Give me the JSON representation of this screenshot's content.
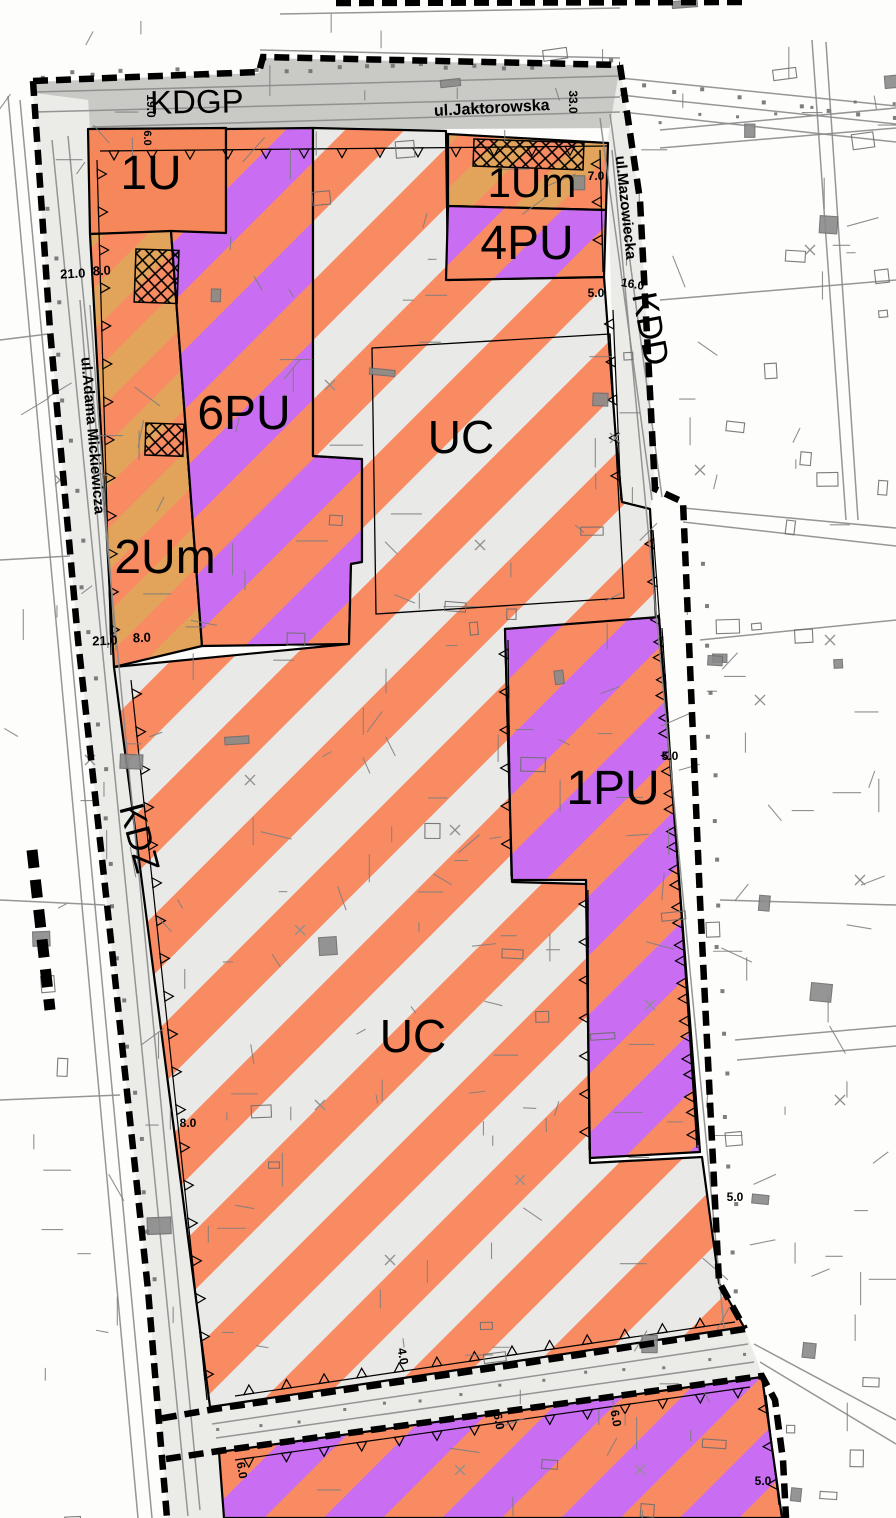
{
  "map_title": "zoning-plan-map",
  "roads": {
    "kdgp": "KDGP",
    "kdd": "KDD",
    "kdz": "KDZ"
  },
  "streets": {
    "jaktorowska": "ul.Jaktorowska",
    "mazowiecka": "ul.Mazowiecka",
    "mickiewicza": "ul.Adama Mickiewicza"
  },
  "zones": [
    {
      "id": "1U",
      "label": "1U"
    },
    {
      "id": "1Um",
      "label": "1Um"
    },
    {
      "id": "4PU",
      "label": "4PU"
    },
    {
      "id": "6PU",
      "label": "6PU"
    },
    {
      "id": "2Um",
      "label": "2Um"
    },
    {
      "id": "UC-north",
      "label": "UC"
    },
    {
      "id": "1PU",
      "label": "1PU"
    },
    {
      "id": "UC-south",
      "label": "UC"
    }
  ],
  "labels": [
    {
      "name": "road-label-kdgp",
      "text": "KDGP",
      "x": 197,
      "y": 113,
      "r": -1,
      "size": 33,
      "weight": 400
    },
    {
      "name": "street-label-jaktorowska",
      "text": "ul.Jaktorowska",
      "x": 492,
      "y": 113,
      "r": -3,
      "size": 16,
      "weight": 700
    },
    {
      "name": "dim-19-0",
      "text": "19.0",
      "x": 147,
      "y": 106,
      "r": 90,
      "size": 12,
      "weight": 700
    },
    {
      "name": "dim-6-0-a",
      "text": "6.0",
      "x": 144,
      "y": 138,
      "r": 90,
      "size": 11,
      "weight": 700
    },
    {
      "name": "dim-33-0",
      "text": "33.0",
      "x": 569,
      "y": 102,
      "r": 90,
      "size": 12,
      "weight": 700
    },
    {
      "name": "zone-label-1u",
      "text": "1U",
      "x": 151,
      "y": 189,
      "r": 0,
      "size": 48,
      "weight": 400
    },
    {
      "name": "zone-label-1um",
      "text": "1Um",
      "x": 532,
      "y": 197,
      "r": 0,
      "size": 42,
      "weight": 400
    },
    {
      "name": "dim-7-0",
      "text": "7.0",
      "x": 596,
      "y": 180,
      "r": 0,
      "size": 12,
      "weight": 700
    },
    {
      "name": "zone-label-4pu",
      "text": "4PU",
      "x": 527,
      "y": 259,
      "r": 0,
      "size": 48,
      "weight": 400
    },
    {
      "name": "street-label-mazowiecka",
      "text": "ul.Mazowiecka",
      "x": 621,
      "y": 208,
      "r": 84,
      "size": 15,
      "weight": 700
    },
    {
      "name": "dim-5-0-a",
      "text": "5.0",
      "x": 596,
      "y": 297,
      "r": 0,
      "size": 12,
      "weight": 700
    },
    {
      "name": "dim-16-0",
      "text": "16.0",
      "x": 632,
      "y": 288,
      "r": 10,
      "size": 12,
      "weight": 700
    },
    {
      "name": "road-label-kdd",
      "text": "KDD",
      "x": 639,
      "y": 331,
      "r": 79,
      "size": 35,
      "weight": 400
    },
    {
      "name": "dim-21-0-a",
      "text": "21.0",
      "x": 73,
      "y": 278,
      "r": -3,
      "size": 13,
      "weight": 700
    },
    {
      "name": "dim-8-0-a",
      "text": "8.0",
      "x": 102,
      "y": 275,
      "r": -3,
      "size": 13,
      "weight": 700
    },
    {
      "name": "zone-label-6pu",
      "text": "6PU",
      "x": 244,
      "y": 429,
      "r": 0,
      "size": 48,
      "weight": 400
    },
    {
      "name": "zone-label-uc-north",
      "text": "UC",
      "x": 461,
      "y": 453,
      "r": 0,
      "size": 46,
      "weight": 400
    },
    {
      "name": "zone-label-2um",
      "text": "2Um",
      "x": 165,
      "y": 573,
      "r": 0,
      "size": 48,
      "weight": 400
    },
    {
      "name": "dim-21-0-b",
      "text": "21.0",
      "x": 105,
      "y": 645,
      "r": -2,
      "size": 13,
      "weight": 700
    },
    {
      "name": "dim-8-0-b",
      "text": "8.0",
      "x": 142,
      "y": 642,
      "r": -2,
      "size": 13,
      "weight": 700
    },
    {
      "name": "street-label-mickiewicza",
      "text": "ul.Adama Mickiewicza",
      "x": 88,
      "y": 436,
      "r": 85,
      "size": 15,
      "weight": 700
    },
    {
      "name": "road-label-kdz",
      "text": "KDZ",
      "x": 128,
      "y": 841,
      "r": 75,
      "size": 35,
      "weight": 400
    },
    {
      "name": "zone-label-1pu",
      "text": "1PU",
      "x": 613,
      "y": 804,
      "r": 0,
      "size": 48,
      "weight": 400
    },
    {
      "name": "zone-label-uc-south",
      "text": "UC",
      "x": 413,
      "y": 1052,
      "r": 0,
      "size": 46,
      "weight": 400
    },
    {
      "name": "dim-8-0-c",
      "text": "8.0",
      "x": 188,
      "y": 1127,
      "r": 0,
      "size": 12,
      "weight": 700
    },
    {
      "name": "dim-5-0-b",
      "text": "5.0",
      "x": 670,
      "y": 760,
      "r": 0,
      "size": 12,
      "weight": 700
    },
    {
      "name": "dim-5-0-c",
      "text": "5.0",
      "x": 735,
      "y": 1201,
      "r": 0,
      "size": 12,
      "weight": 700
    },
    {
      "name": "dim-4-0",
      "text": "4.0",
      "x": 399,
      "y": 1357,
      "r": 80,
      "size": 12,
      "weight": 700
    },
    {
      "name": "dim-6-0-b",
      "text": "6.0",
      "x": 495,
      "y": 1422,
      "r": 80,
      "size": 12,
      "weight": 700
    },
    {
      "name": "dim-6-0-c",
      "text": "6.0",
      "x": 238,
      "y": 1471,
      "r": 80,
      "size": 12,
      "weight": 700
    },
    {
      "name": "dim-6-0-d",
      "text": "6.0",
      "x": 612,
      "y": 1419,
      "r": 80,
      "size": 12,
      "weight": 700
    },
    {
      "name": "dim-5-0-d",
      "text": "5.0",
      "x": 763,
      "y": 1485,
      "r": 0,
      "size": 12,
      "weight": 700
    }
  ],
  "colors": {
    "zone_salmon": "#f98b63",
    "zone_stripe_gray": "#e9e9e7",
    "zone_purple": "#c96ef2",
    "zone_tan": "#e2a45b",
    "zone_solid_orange": "#f6875a",
    "road_fill": "#c9c9c6",
    "corridor_fill": "#ebebe8",
    "cadastre_gray": "#7d7d7d",
    "boundary_black": "#000000"
  }
}
